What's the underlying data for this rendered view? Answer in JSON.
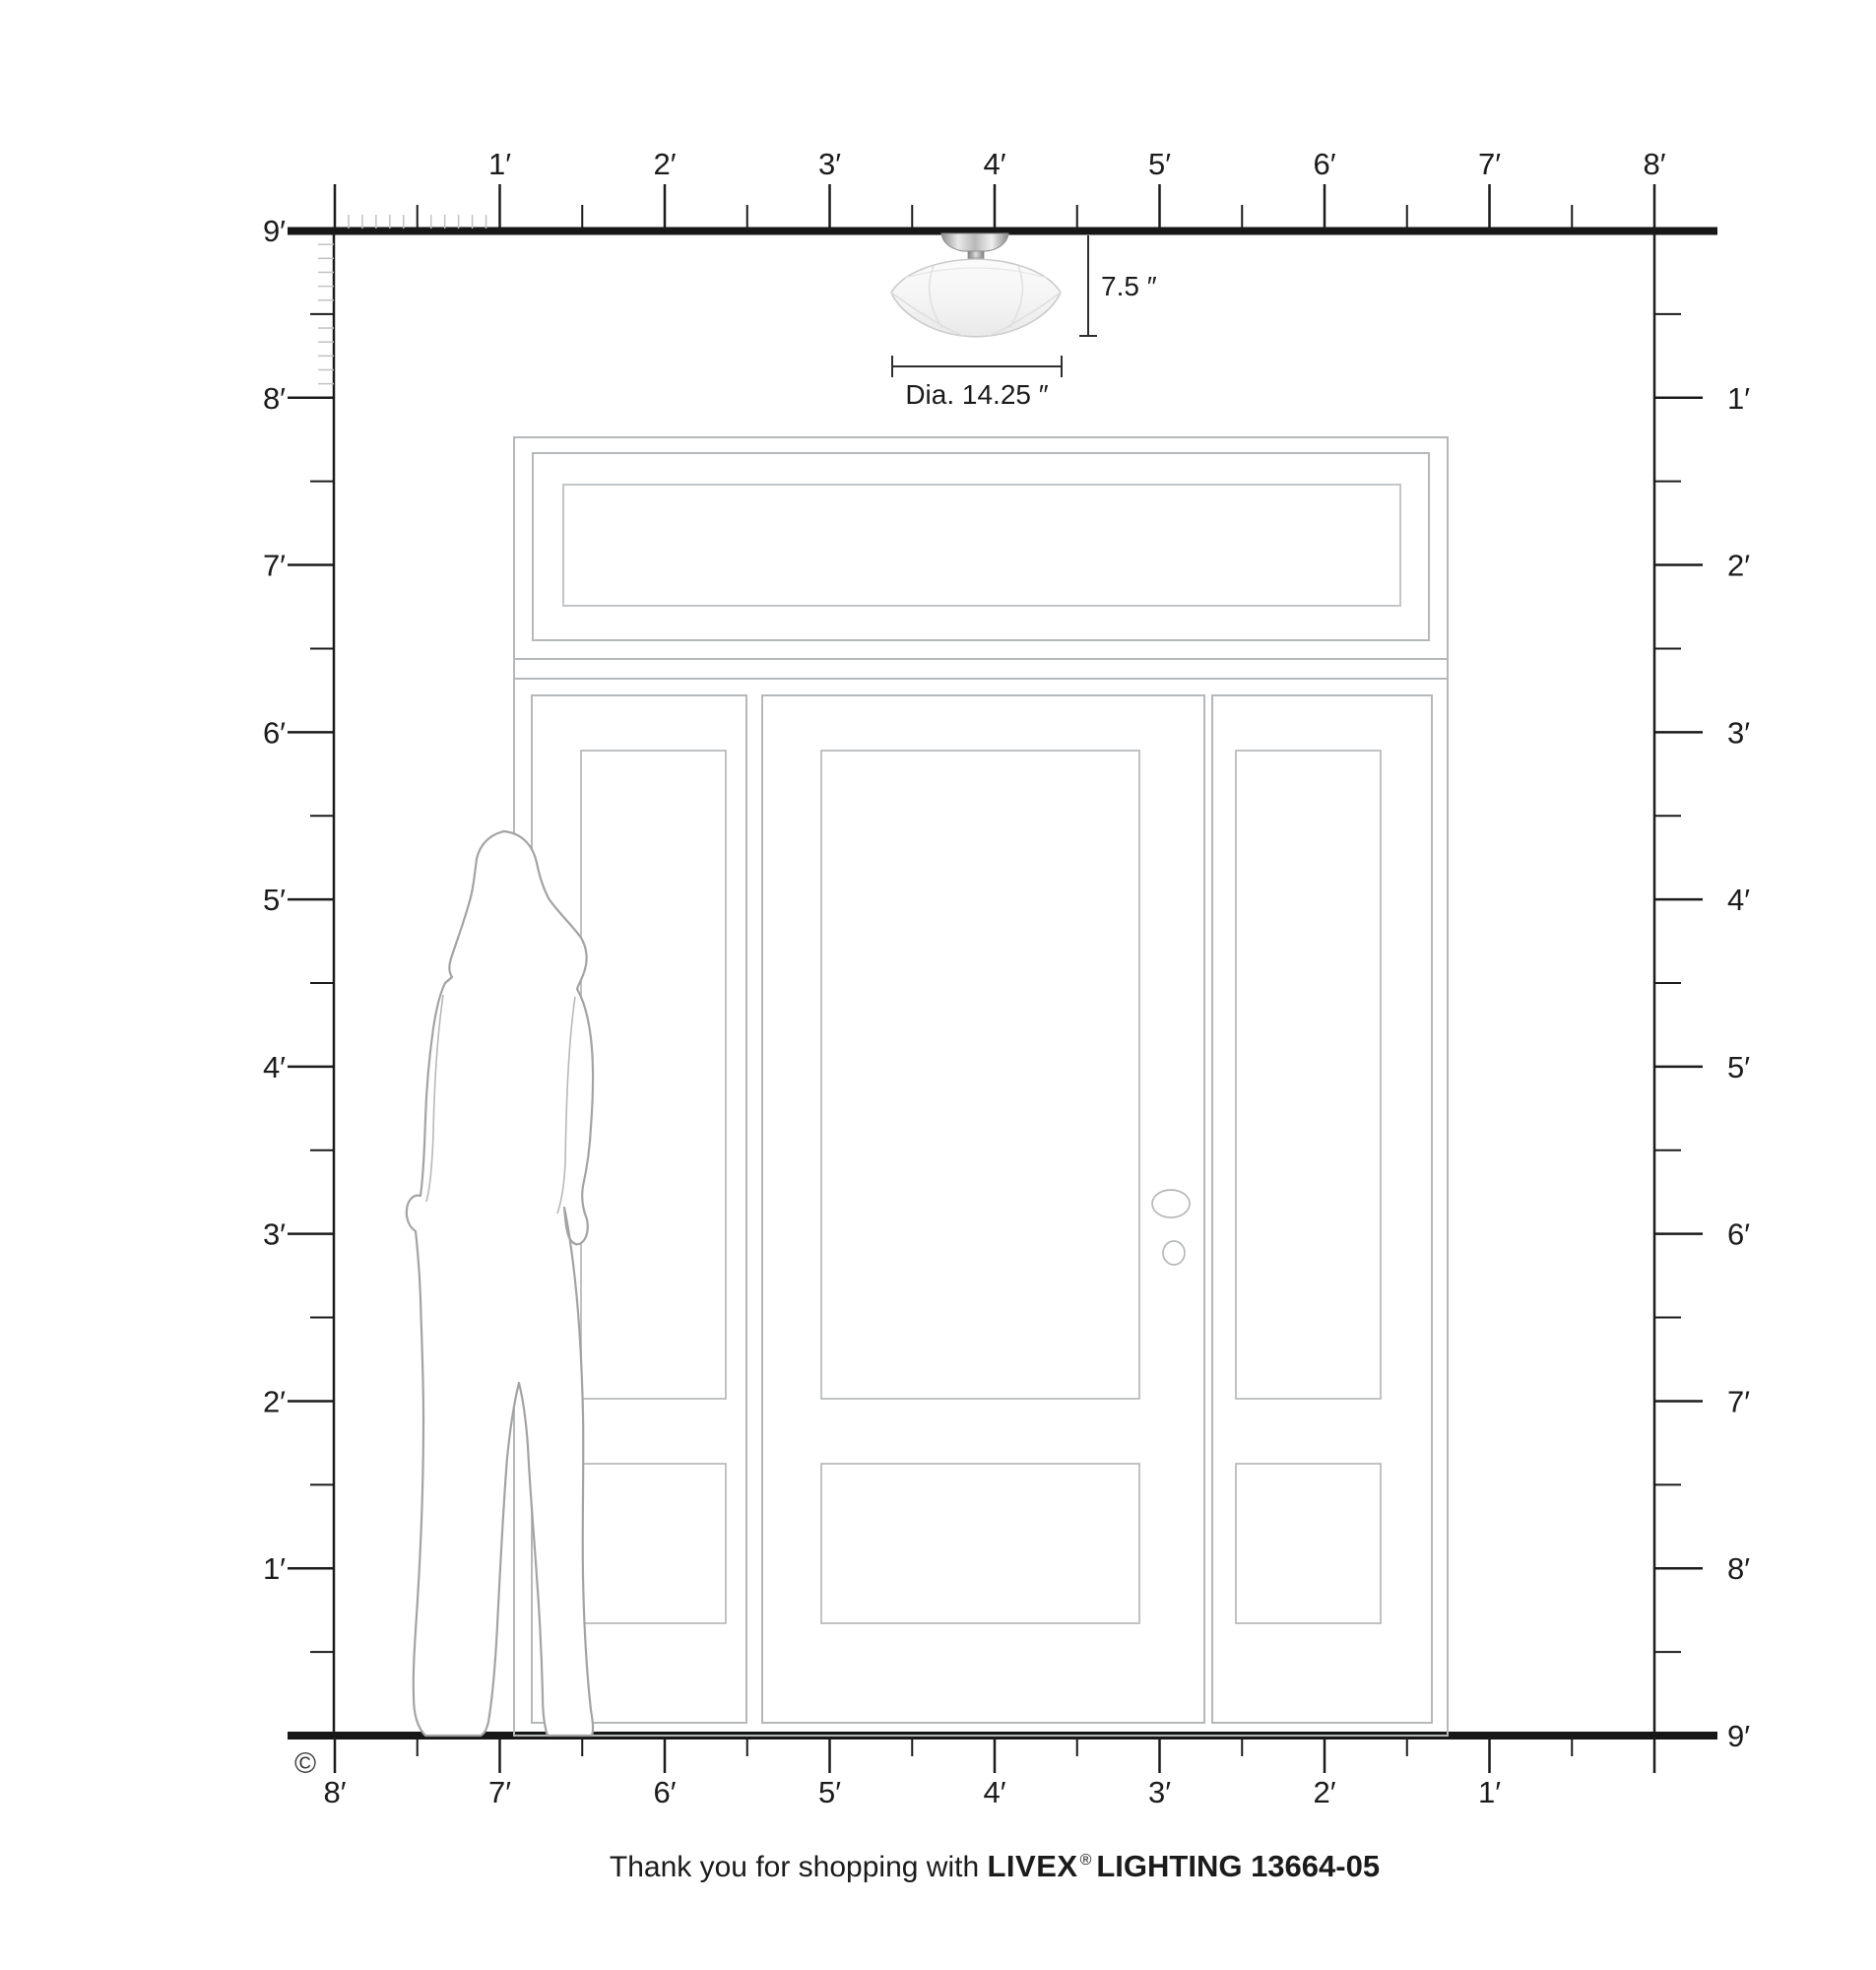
{
  "diagram": {
    "type": "product-scale-diagram",
    "room": {
      "height_feet": 9,
      "width_feet": 8
    }
  },
  "rulers": {
    "top": {
      "labels": [
        "1′",
        "2′",
        "3′",
        "4′",
        "5′",
        "6′",
        "7′",
        "8′"
      ]
    },
    "bottom": {
      "labels": [
        "8′",
        "7′",
        "6′",
        "5′",
        "4′",
        "3′",
        "2′",
        "1′"
      ]
    },
    "left": {
      "labels": [
        "9′",
        "8′",
        "7′",
        "6′",
        "5′",
        "4′",
        "3′",
        "2′",
        "1′"
      ]
    },
    "right": {
      "labels": [
        "1′",
        "2′",
        "3′",
        "4′",
        "5′",
        "6′",
        "7′",
        "8′",
        "9′"
      ]
    }
  },
  "fixture": {
    "name": "semi-flush ceiling light",
    "height_label": "7.5 ″",
    "diameter_label": "Dia. 14.25 ″"
  },
  "footer": {
    "thanks": "Thank you for shopping with ",
    "brand": "LIVEX",
    "registered": "®",
    "product_line": "LIGHTING 13664-05"
  },
  "copyright": "©",
  "colors": {
    "ink": "#1b1b1b",
    "tick_minor": "#c2c2c2",
    "door_line": "#b5b8ba",
    "figure_line": "#a3a3a3",
    "dim_line": "#2e2e2e",
    "glass_edge": "#cbcbcb"
  }
}
